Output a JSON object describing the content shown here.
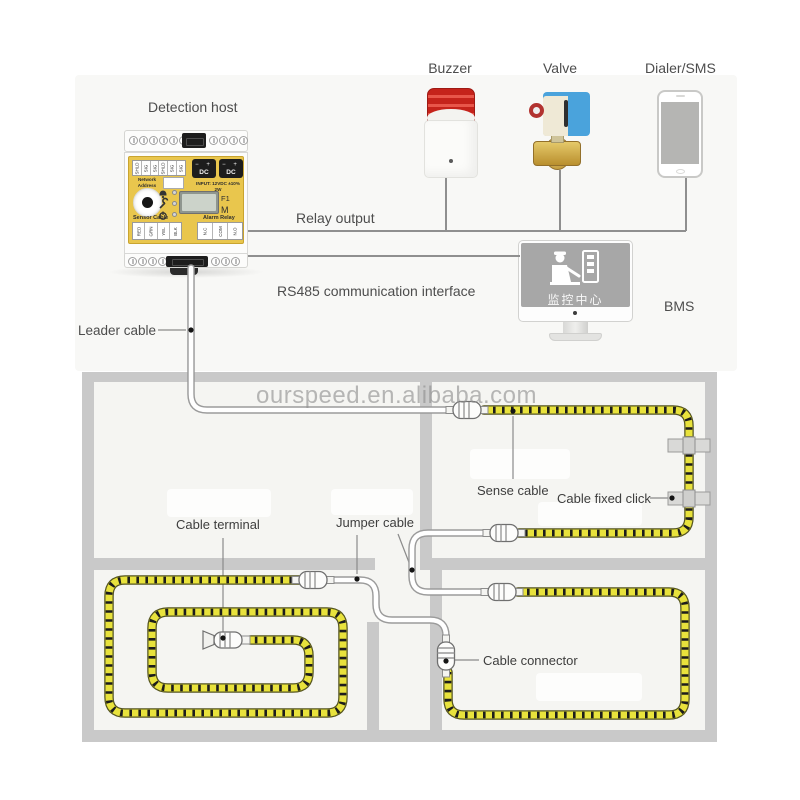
{
  "watermark": "ourspeed.en.alibaba.com",
  "top": {
    "detection_host": "Detection host",
    "buzzer": "Buzzer",
    "valve": "Valve",
    "dialer": "Dialer/SMS",
    "relay_output": "Relay output",
    "rs485": "RS485 communication interface",
    "bms": "BMS",
    "leader_cable": "Leader cable",
    "monitor_screen_text": "监控中心"
  },
  "device_panel": {
    "top_terminals": [
      "SHLD",
      "SIG",
      "SIG",
      "SHLD",
      "SIG",
      "SIG"
    ],
    "network_label": "Network Address",
    "dc_polarity": "−  +",
    "dc_label": "DC",
    "input_rating": "INPUT: 12VDC ±10%",
    "input_power": "2W",
    "f1": "F1",
    "m": "M",
    "sensor_cable": "Sensor Cable",
    "alarm_relay": "Alarm Relay",
    "sensor_terminals": [
      "RED",
      "GRN",
      "YEL",
      "BLK"
    ],
    "relay_terminals": [
      "N.C",
      "COM",
      "N.O"
    ]
  },
  "floor_plan": {
    "sense_cable": "Sense cable",
    "cable_fixed_click": "Cable fixed click",
    "cable_terminal": "Cable terminal",
    "jumper_cable": "Jumper cable",
    "cable_connector": "Cable connector"
  },
  "colors": {
    "device_face": "#e9c64d",
    "sense_cable_yellow": "#e8e23c",
    "wall_gray": "#c9c9c9",
    "buzzer_red": "#c5231b",
    "valve_blue": "#4aa3dc",
    "valve_brass": "#c8a145",
    "monitor_screen": "#a7a7a7",
    "line_gray": "#8f8f8f"
  }
}
